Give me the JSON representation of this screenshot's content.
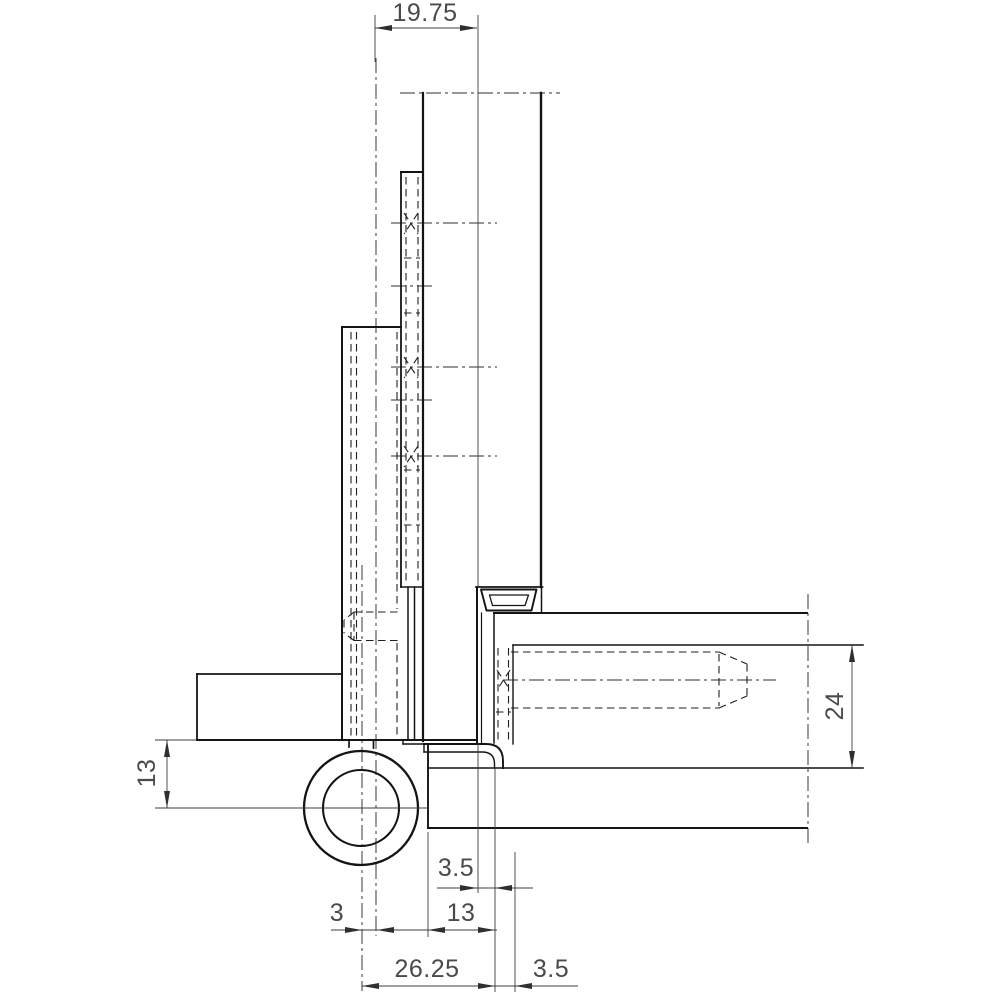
{
  "drawing": {
    "subject": "door-hinge-cross-section",
    "colors": {
      "background": "#ffffff",
      "outline": "#141414",
      "dimension_lines": "#3d3d3d",
      "dimension_text": "#4a4a4a"
    },
    "dimensions": {
      "top_width": "19.75",
      "left_height": "13",
      "frame_depth": "24",
      "mid_gap": "3.5",
      "mid_width": "13",
      "pin_offset": "3",
      "bottom_width": "26.25",
      "bottom_gap": "3.5"
    }
  }
}
